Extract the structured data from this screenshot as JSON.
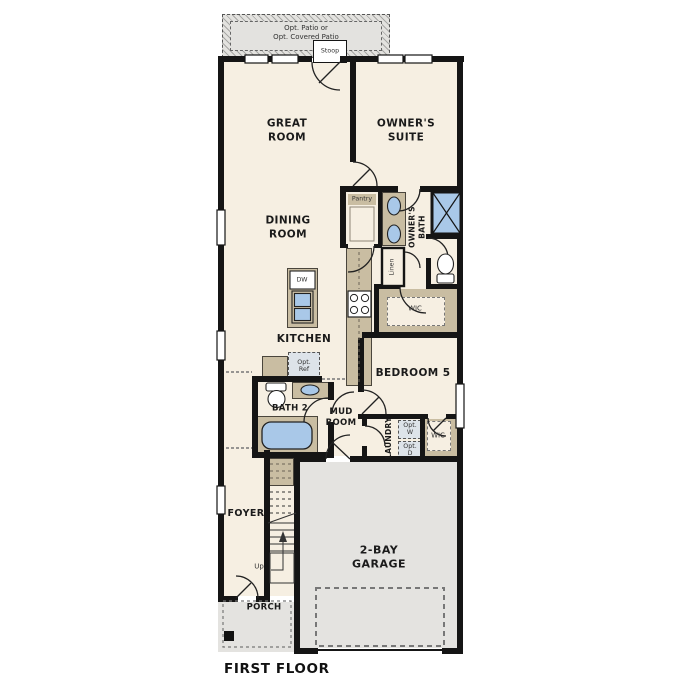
{
  "title": {
    "floor": "FIRST FLOOR"
  },
  "colors": {
    "floor_cream": "#f6efe2",
    "wall_black": "#151515",
    "cabinet_tan": "#c9bda2",
    "concrete_gray": "#e4e3e0",
    "fixture_blue": "#a9c8e8",
    "optional_fill": "#dde3e9"
  },
  "rooms": {
    "opt_patio": {
      "line1": "Opt. Patio or",
      "line2": "Opt. Covered Patio"
    },
    "stoop": {
      "label": "Stoop"
    },
    "great_room": {
      "line1": "GREAT",
      "line2": "ROOM"
    },
    "owners_suite": {
      "line1": "OWNER'S",
      "line2": "SUITE"
    },
    "dining_room": {
      "line1": "DINING",
      "line2": "ROOM"
    },
    "pantry": {
      "label": "Pantry"
    },
    "owners_bath": {
      "line1": "OWNER'S",
      "line2": "BATH"
    },
    "linen": {
      "label": "Linen"
    },
    "owners_wic": {
      "label": "WIC"
    },
    "kitchen": {
      "label": "KITCHEN",
      "dishwasher": "DW",
      "opt_ref": {
        "line1": "Opt.",
        "line2": "Ref"
      }
    },
    "bath2": {
      "label": "BATH 2"
    },
    "mud_room": {
      "line1": "MUD",
      "line2": "ROOM"
    },
    "laundry": {
      "label": "LAUNDRY",
      "opt_washer": {
        "line1": "Opt.",
        "line2": "W"
      },
      "opt_dryer": {
        "line1": "Opt.",
        "line2": "D"
      }
    },
    "bedroom5": {
      "label": "BEDROOM 5"
    },
    "wic2": {
      "label": "WIC"
    },
    "foyer": {
      "label": "FOYER"
    },
    "stairs": {
      "up": "Up"
    },
    "garage": {
      "line1": "2-BAY",
      "line2": "GARAGE"
    },
    "porch": {
      "label": "PORCH"
    }
  }
}
